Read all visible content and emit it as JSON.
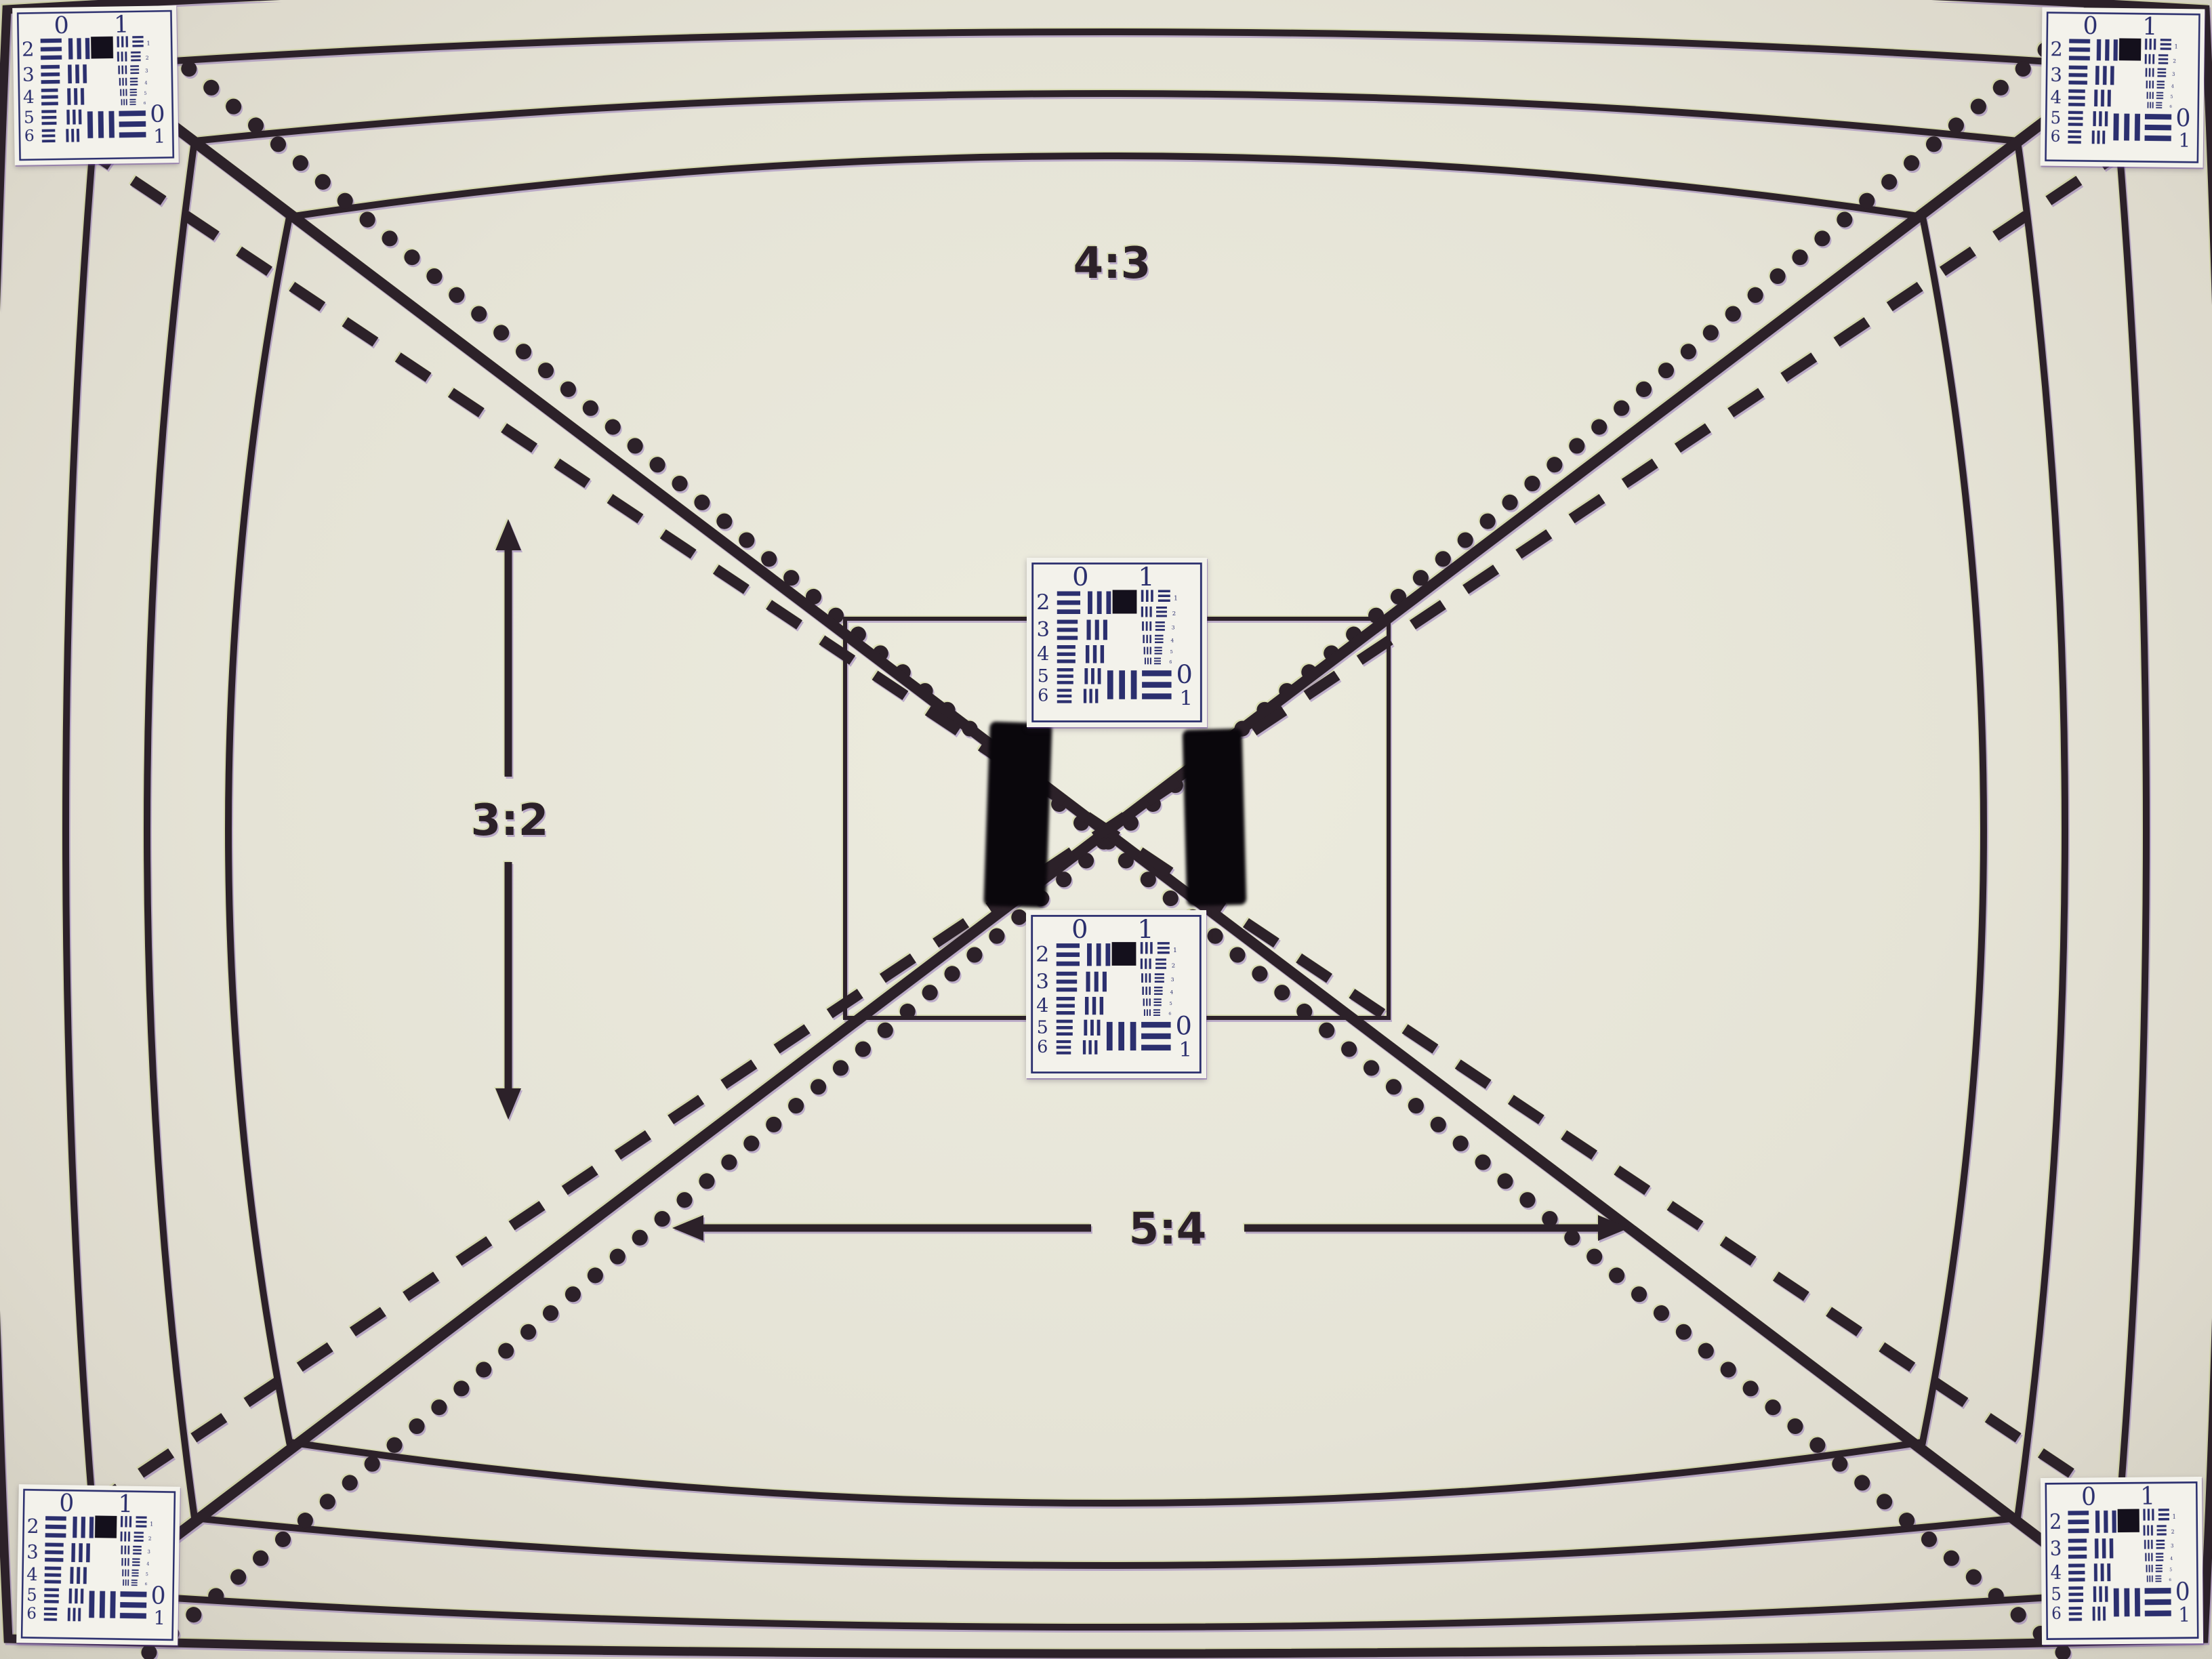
{
  "meta": {
    "description": "Photograph of a camera field-of-view / resolution test chart",
    "chart_kind": "aspect-ratio and USAF-1951 resolution test chart"
  },
  "labels": {
    "aspect_top": "4:3",
    "aspect_left": "3:2",
    "aspect_bottom": "5:4"
  },
  "usaf": {
    "top_labels": [
      "0",
      "1"
    ],
    "group_rows": [
      "2",
      "3",
      "4",
      "5",
      "6"
    ],
    "element_numbers": [
      "1",
      "2",
      "3",
      "4",
      "5",
      "6"
    ],
    "bottom_labels": [
      "0",
      "1"
    ]
  },
  "colors": {
    "background_center": "#edecdf",
    "background_edge": "#cfcbbd",
    "ink": "#2c2129",
    "card_ink": "#2b2f6e",
    "card_bg": "#f3f2eb",
    "pad_black": "#0a070c"
  }
}
